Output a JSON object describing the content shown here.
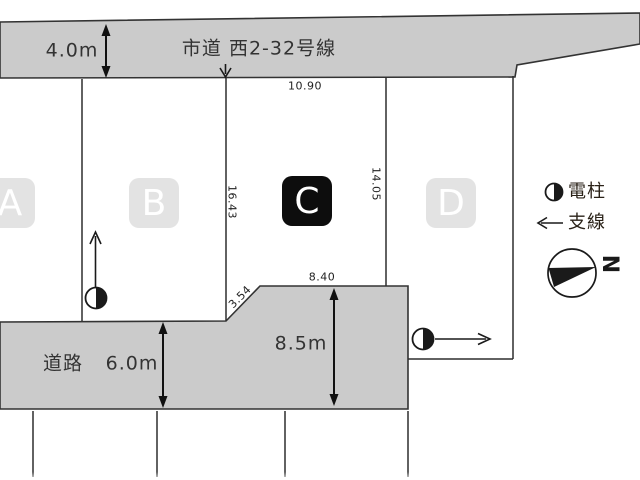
{
  "top_road": {
    "label": "市道 西2-32号線",
    "width": "4.0m"
  },
  "bottom_road": {
    "label": "道路",
    "width": "6.0m",
    "extension_width": "8.5m"
  },
  "lots": [
    {
      "id": "A",
      "highlighted": false
    },
    {
      "id": "B",
      "highlighted": false
    },
    {
      "id": "C",
      "highlighted": true
    },
    {
      "id": "D",
      "highlighted": false
    }
  ],
  "dimensions": {
    "lot_c_top": "10.90",
    "lot_c_left": "16.43",
    "lot_c_right": "14.05",
    "lot_c_bottom": "8.40",
    "lot_c_corner": "3.54"
  },
  "legend": {
    "pole_label": "電柱",
    "guy_wire_label": "支線",
    "pole_icon": "utility-pole-half-circle",
    "guy_wire_icon": "left-arrow"
  },
  "compass": {
    "north_label": "N"
  },
  "colors": {
    "road_fill": "#cbcbcb",
    "line": "#2e2e2e",
    "badge_gray": "#e3e3e3",
    "badge_black": "#0d0d0d",
    "symbol_black": "#1a1a1a"
  }
}
